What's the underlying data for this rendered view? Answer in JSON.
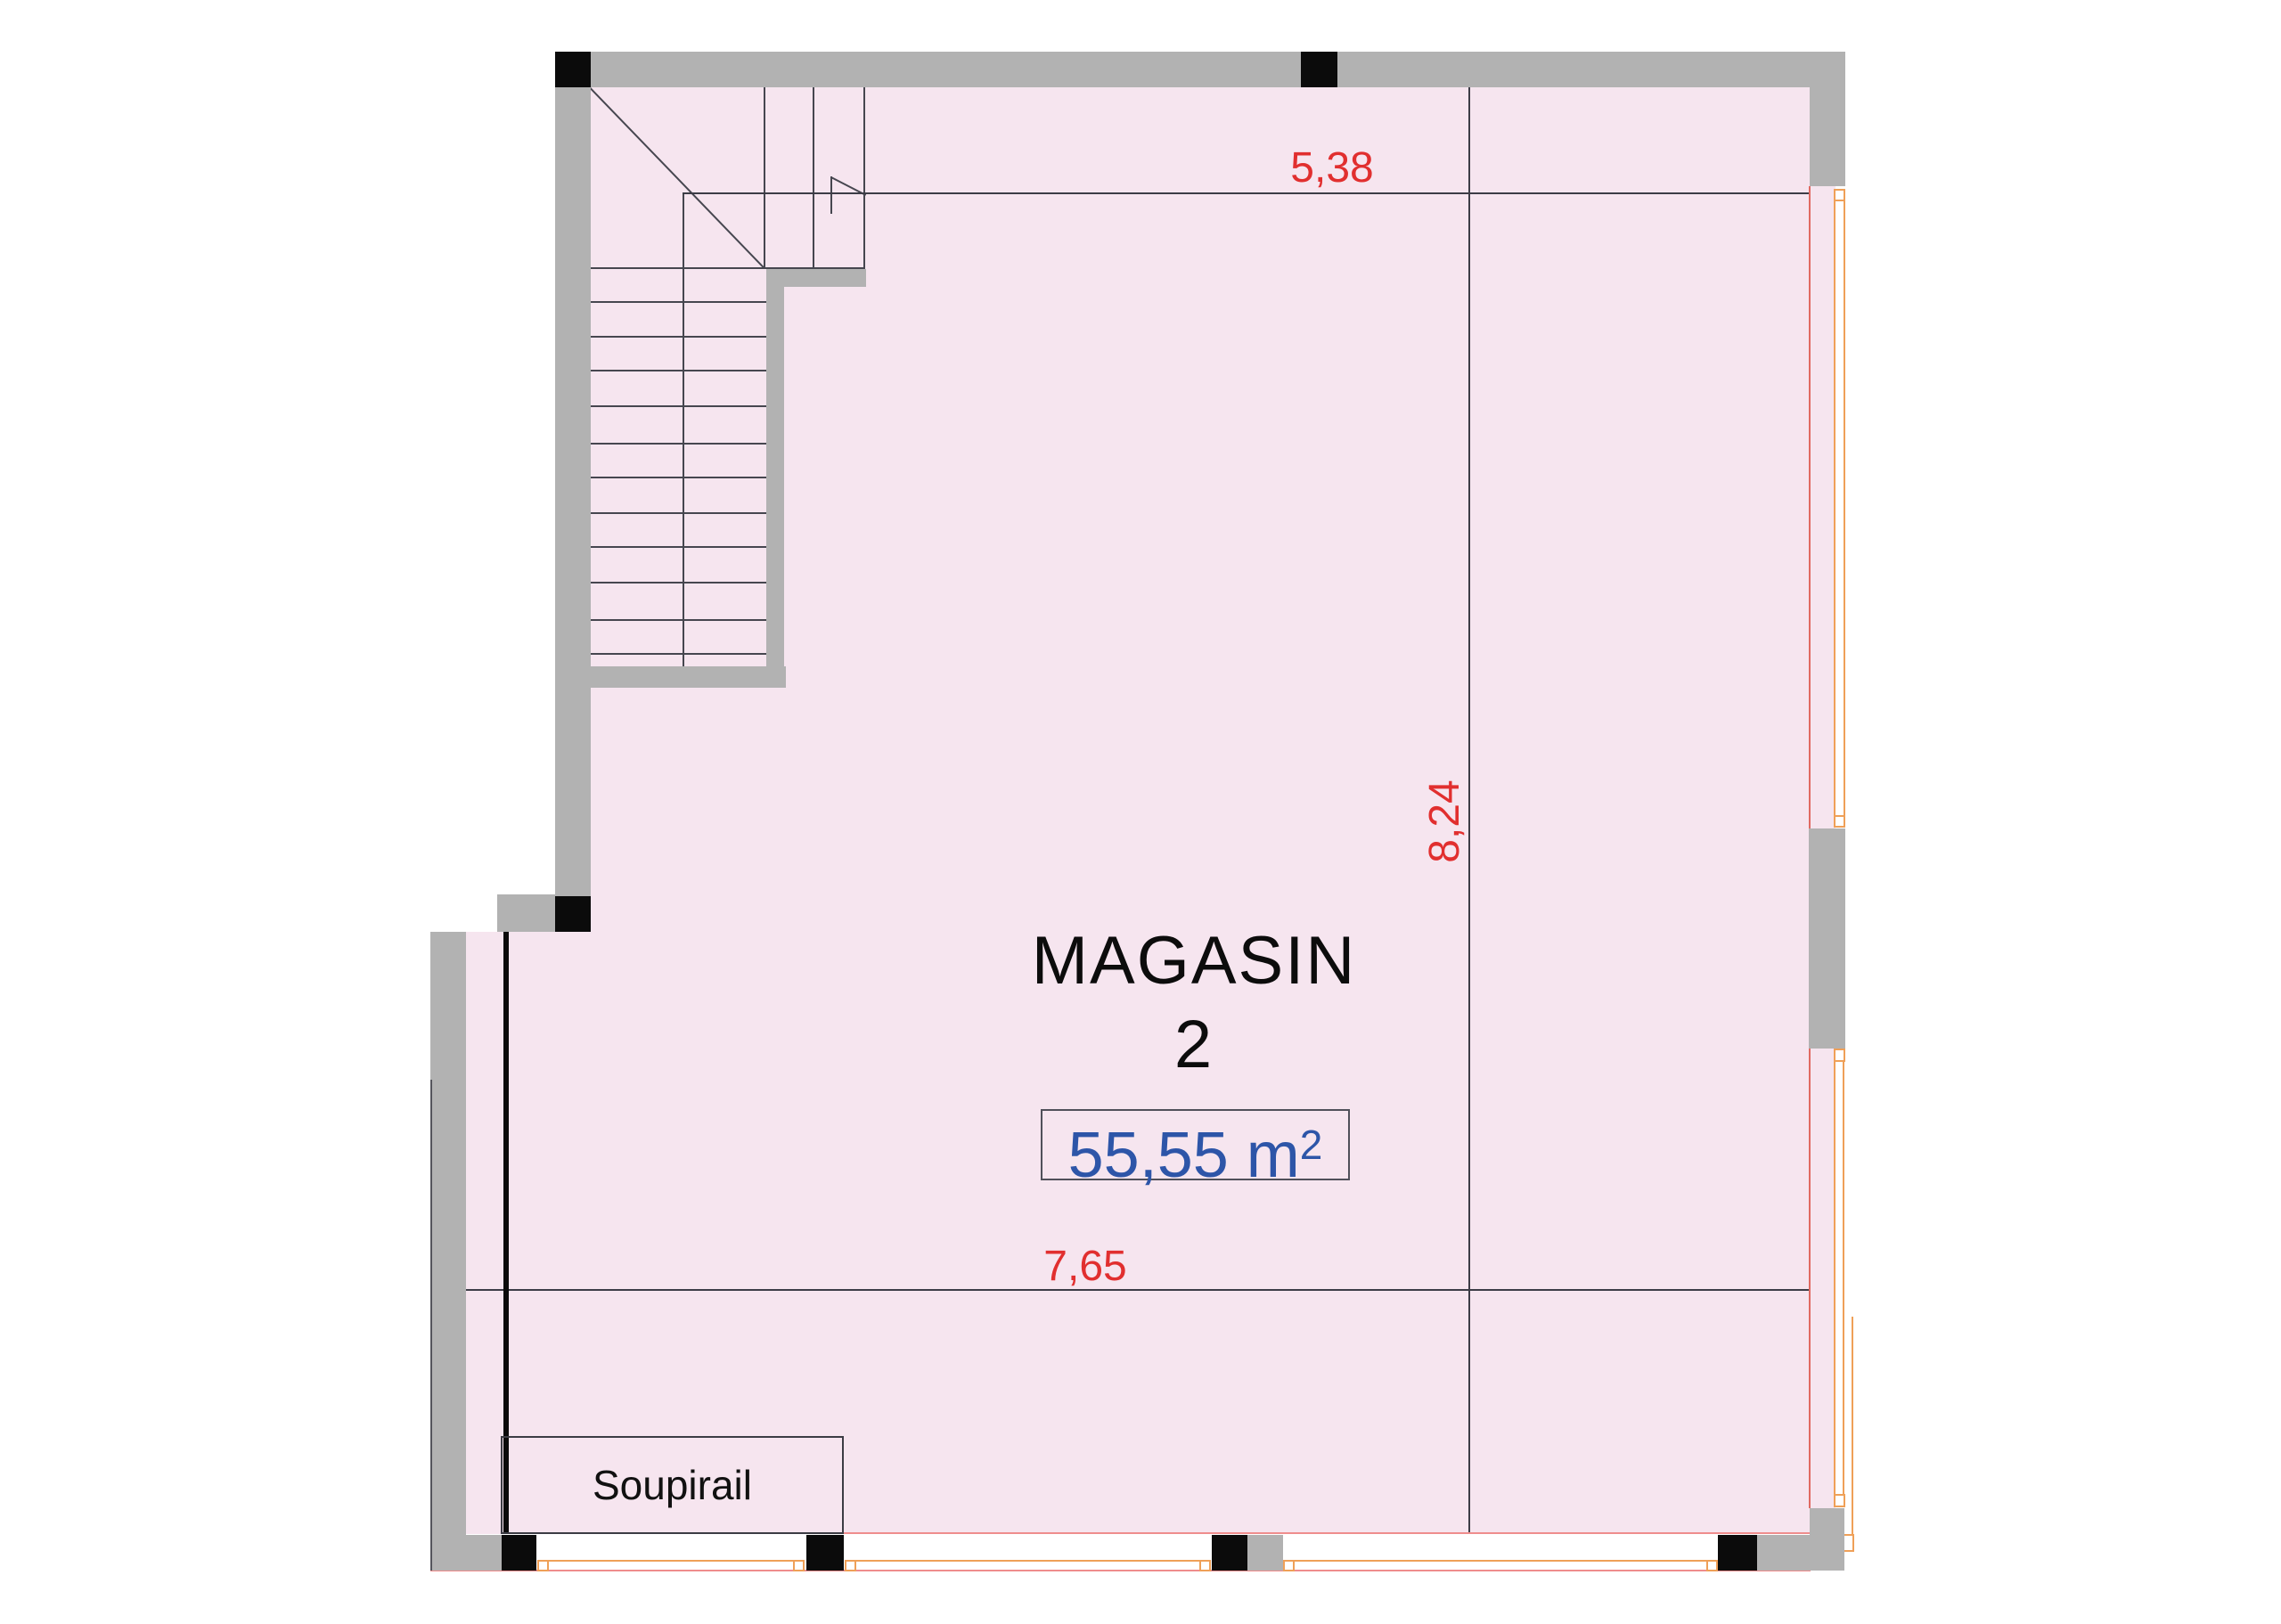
{
  "room": {
    "name_line1": "MAGASIN",
    "name_line2": "2",
    "area_value": "55,55 m",
    "area_sup": "2"
  },
  "annotations": {
    "basement_window_label": "Soupirail"
  },
  "dimensions": {
    "top_width": "5,38",
    "bottom_width": "7,65",
    "height": "8,24"
  },
  "colors": {
    "room_fill": "#f6e5ef",
    "wall_gray": "#b2b2b2",
    "column_black": "#0b0b0b",
    "dimension_red": "#e12f2f",
    "area_blue": "#2d55a8",
    "window_frame_orange": "#efa058",
    "window_sill_red": "#ef8d8d",
    "drawing_line": "#46464f"
  }
}
